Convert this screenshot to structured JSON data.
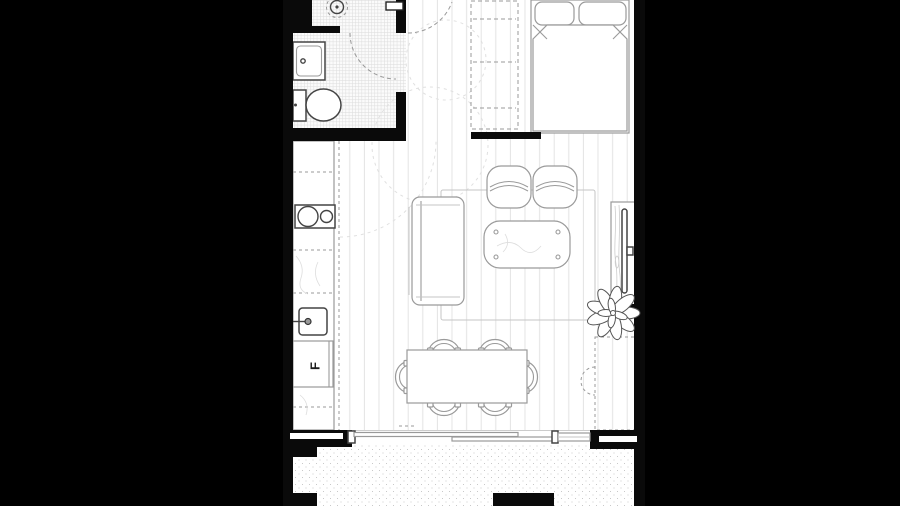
{
  "floorplan": {
    "fridge_label": "F",
    "colors": {
      "background": "#000000",
      "wall": "#0a0a0a",
      "floor": "#ffffff",
      "furniture_line": "#9a9a9a",
      "fixture_line": "#444444",
      "dash_line": "#999999",
      "pale_line": "#e0e0e0",
      "plank_line": "#e3e3e3",
      "tile_line": "#dcdcdc",
      "stipple_dot": "#c9c9c9"
    },
    "rooms": [
      {
        "name": "bathroom"
      },
      {
        "name": "entry-hall"
      },
      {
        "name": "kitchen"
      },
      {
        "name": "living-dining"
      },
      {
        "name": "sleeping-area"
      },
      {
        "name": "balcony"
      }
    ],
    "elements": [
      "shower-drain",
      "vanity-basin",
      "toilet",
      "bathroom-door-swing",
      "entry-door",
      "wardrobe",
      "bed",
      "kitchen-counter",
      "cooktop",
      "kitchen-sink",
      "fridge",
      "rug",
      "sofa",
      "armchair",
      "coffee-table",
      "tv-unit",
      "plant",
      "dining-table",
      "dining-chair",
      "sliding-door",
      "balcony-wall",
      "window-slot"
    ]
  }
}
